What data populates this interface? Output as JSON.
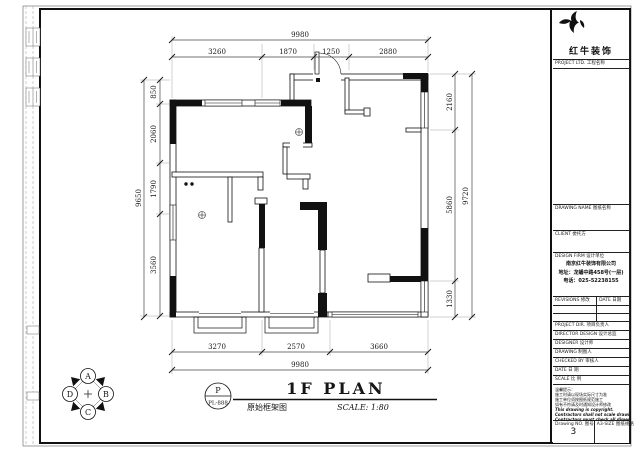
{
  "plan": {
    "title": "1F PLAN",
    "subtitle": "原始框架图",
    "scale_note": "SCALE: 1:80",
    "stamp": {
      "top": "P",
      "bottom": "PL-888"
    },
    "compass": {
      "north": "A",
      "east": "B",
      "south": "C",
      "west": "D"
    },
    "dims": {
      "top_overall": "9980",
      "top": [
        "3260",
        "1870",
        "1250",
        "2880"
      ],
      "left_overall": "9650",
      "left": [
        "850",
        "2060",
        "1790",
        "3560"
      ],
      "right_overall": "9720",
      "right": [
        "2160",
        "5860",
        "1330"
      ],
      "bottom_overall": "9980",
      "bottom": [
        "3270",
        "2570",
        "3660"
      ]
    }
  },
  "title_block": {
    "brand": "红牛装饰",
    "brand_sub": "PROJECT LTD. 工程名称",
    "drawing_name_label": "DRAWING NAME 图纸名称",
    "client_label": "CLIENT 委托方",
    "design_firm_label": "DESIGN FIRM 设计单位",
    "company_lines": [
      "南京红牛装饰有限公司",
      "地址：龙蟠中路458号(一层)",
      "电话：025-52238155"
    ],
    "revisions_label": "REVISIONS 修改",
    "date_label": "DATE 日期",
    "row_labels": [
      "PROJECT DIR. 项目负责人",
      "DIRECTOR DESIGN 设计总监",
      "DESIGNER 设计师",
      "DRAWING 制图人",
      "CHECKED BY 审核人",
      "DATE 日 期",
      "SCALE 比 例"
    ],
    "notes": [
      "温馨提示：",
      "施工时请以现场实际尺寸为准",
      "施工单位须按图纸规范施工",
      "如有不符请及时通知设计师修改",
      "This drawing is copyright.",
      "Contractors shall not scale drawings.",
      "Contractors must check all dimensions on site.",
      "Variations must be agreed in writing."
    ],
    "drawing_no_label": "Drawing NO. 图号",
    "drawing_no": "3",
    "paper_label": "A3-SIZE 图纸规格"
  }
}
